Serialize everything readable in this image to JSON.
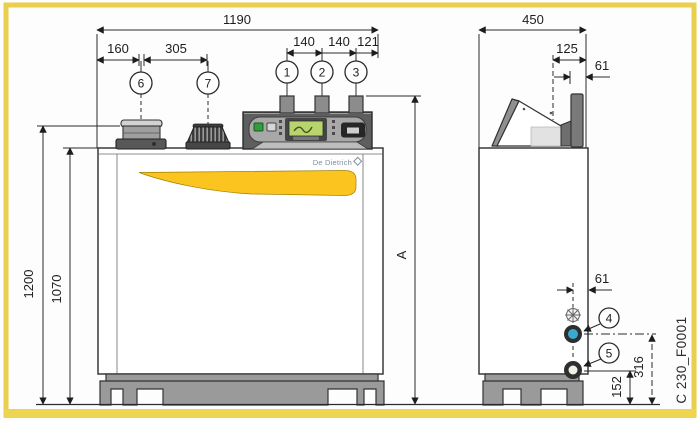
{
  "drawing": {
    "brand": "De Dietrich",
    "part_number": "C 230_F0001",
    "frame_color": "#e9cf4b",
    "accent_yellow": "#fcc41f",
    "connection_blue": "#3aabcf"
  },
  "front_view": {
    "dim_total_width": "1190",
    "dim_flue_offset": "160",
    "dim_cap_spacing": "305",
    "dim_conn_spacing_1": "140",
    "dim_conn_spacing_2": "140",
    "dim_conn_edge": "121",
    "dim_total_height": "1200",
    "dim_jacket_height": "1070",
    "dim_conn_height": "A",
    "callout_conn1": "1",
    "callout_conn2": "2",
    "callout_conn3": "3",
    "callout_flue": "6",
    "callout_cap": "7"
  },
  "side_view": {
    "dim_total_depth": "450",
    "dim_pipe_offset": "125",
    "dim_pipe_edge": "61",
    "dim_conn_offset": "61",
    "dim_conn4_height": "316",
    "dim_conn5_height": "152",
    "callout_conn4": "4",
    "callout_conn5": "5"
  }
}
